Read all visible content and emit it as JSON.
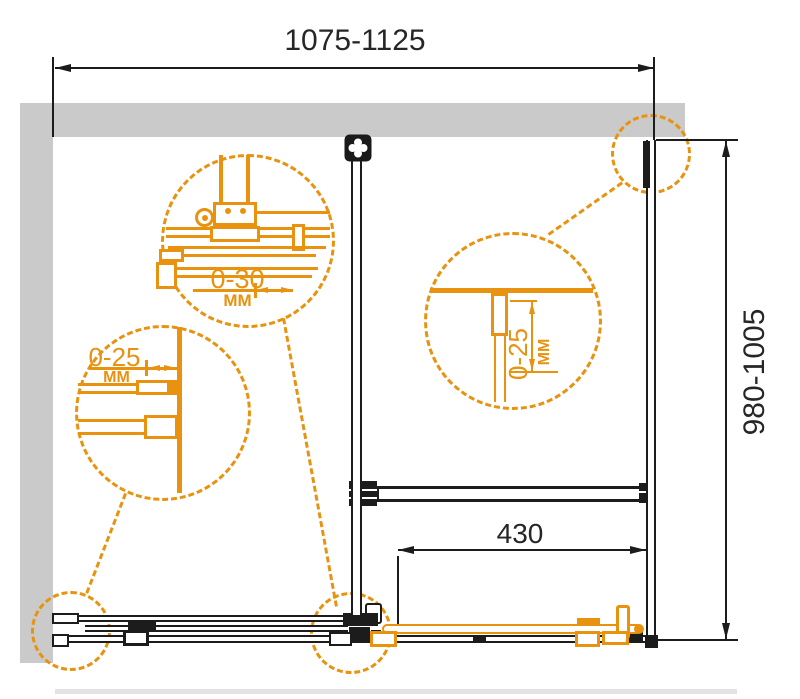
{
  "colors": {
    "accent": "#E8920F",
    "wall_gray": "#CACACA",
    "line_black": "#1C1C1C"
  },
  "dimensions": {
    "top_width_range": "1075-1125",
    "right_height_range": "980-1005",
    "bottom_door_travel": "430"
  },
  "details": {
    "roller_adjustment": {
      "value": "0-30",
      "unit": "MM"
    },
    "left_wall_profile_adjustment": {
      "value": "0-25",
      "unit": "MM"
    },
    "right_wall_profile_adjustment": {
      "value": "0-25",
      "unit": "MM"
    }
  }
}
